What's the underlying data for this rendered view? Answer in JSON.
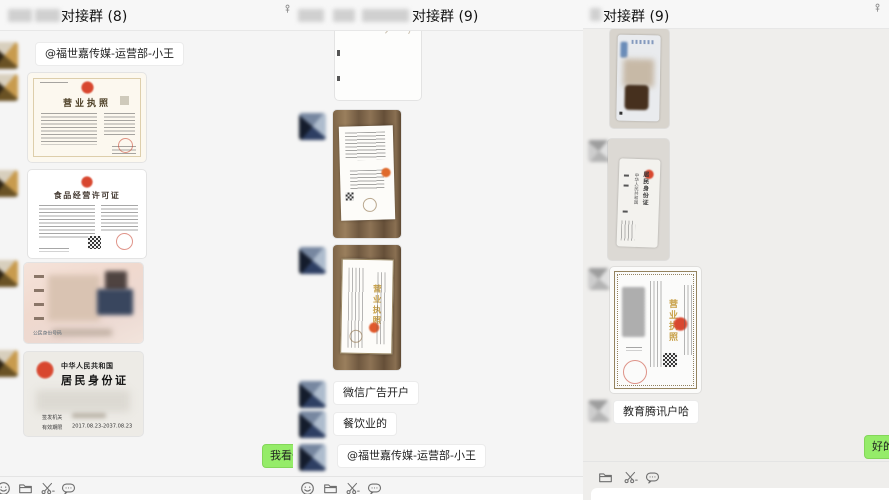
{
  "left_window": {
    "title": "对接群 (8)",
    "messages": {
      "mention_text": "@福世嘉传媒-运营部-小王",
      "outgoing_text": "我看一"
    },
    "business_license": {
      "title": "营业执照"
    },
    "food_permit": {
      "title": "食品经营许可证"
    },
    "id_card_front": {
      "number_label": "公民身份号码"
    },
    "id_card_back": {
      "country": "中华人民共和国",
      "card_type": "居民身份证",
      "issue_label": "签发机关",
      "validity_label": "有效期限",
      "validity_value": "2017.08.23-2037.08.23"
    }
  },
  "middle_window": {
    "title": "对接群 (9)",
    "messages": [
      "微信广告开户",
      "餐饮业的",
      "@福世嘉传媒-运营部-小王"
    ],
    "license_title": "营业执照"
  },
  "right_window": {
    "title": "对接群 (9)",
    "messages": {
      "text": "教育腾讯户哈",
      "outgoing_text": "好的"
    },
    "license_title": "营业执照",
    "id_card_back_vertical": {
      "country": "中华人民共和国",
      "card_type": "居民身份证"
    }
  },
  "toolbar": {
    "icons": [
      "emoji-icon",
      "folder-icon",
      "screenshot-icon",
      "messages-icon"
    ],
    "pin_icon": "pin-icon"
  },
  "colors": {
    "outgoing_bubble": "#95ec69",
    "incoming_bubble": "#ffffff",
    "seal_red": "#cf3f2d",
    "license_gold": "#c9a24b",
    "chat_background": "#f5f5f5"
  }
}
